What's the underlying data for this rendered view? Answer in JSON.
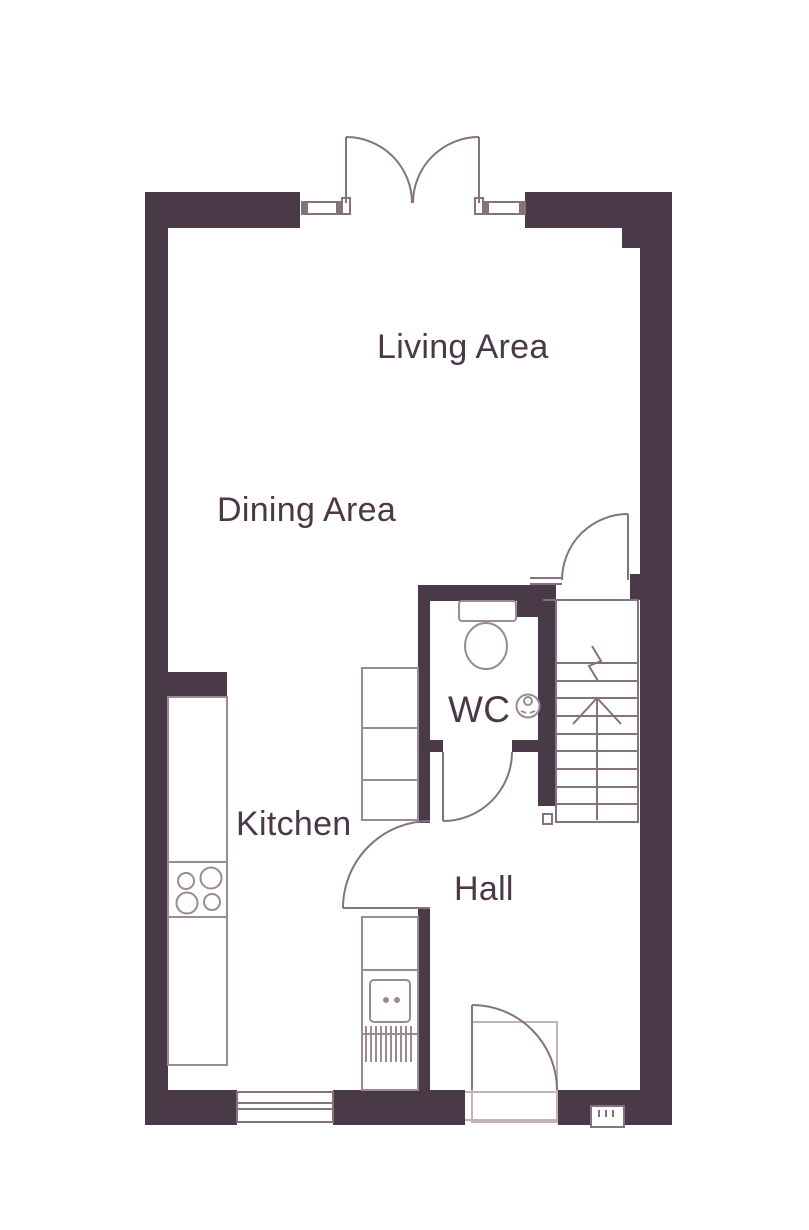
{
  "rooms": {
    "living": "Living Area",
    "dining": "Dining Area",
    "kitchen": "Kitchen",
    "wc": "WC",
    "hall": "Hall"
  },
  "colors": {
    "wall": "#4a3946",
    "line": "#84737e",
    "fixture": "#9a8a92",
    "faint": "#c0b4ba",
    "label": "#4b3846",
    "background": "#ffffff"
  },
  "fixtures": [
    "french-doors",
    "sidelight-windows",
    "living-area-door",
    "wc-door",
    "kitchen-door",
    "front-door",
    "staircase-up",
    "toilet",
    "wash-basin",
    "kitchen-worktops",
    "hob",
    "sink-with-drainer",
    "kitchen-window"
  ]
}
